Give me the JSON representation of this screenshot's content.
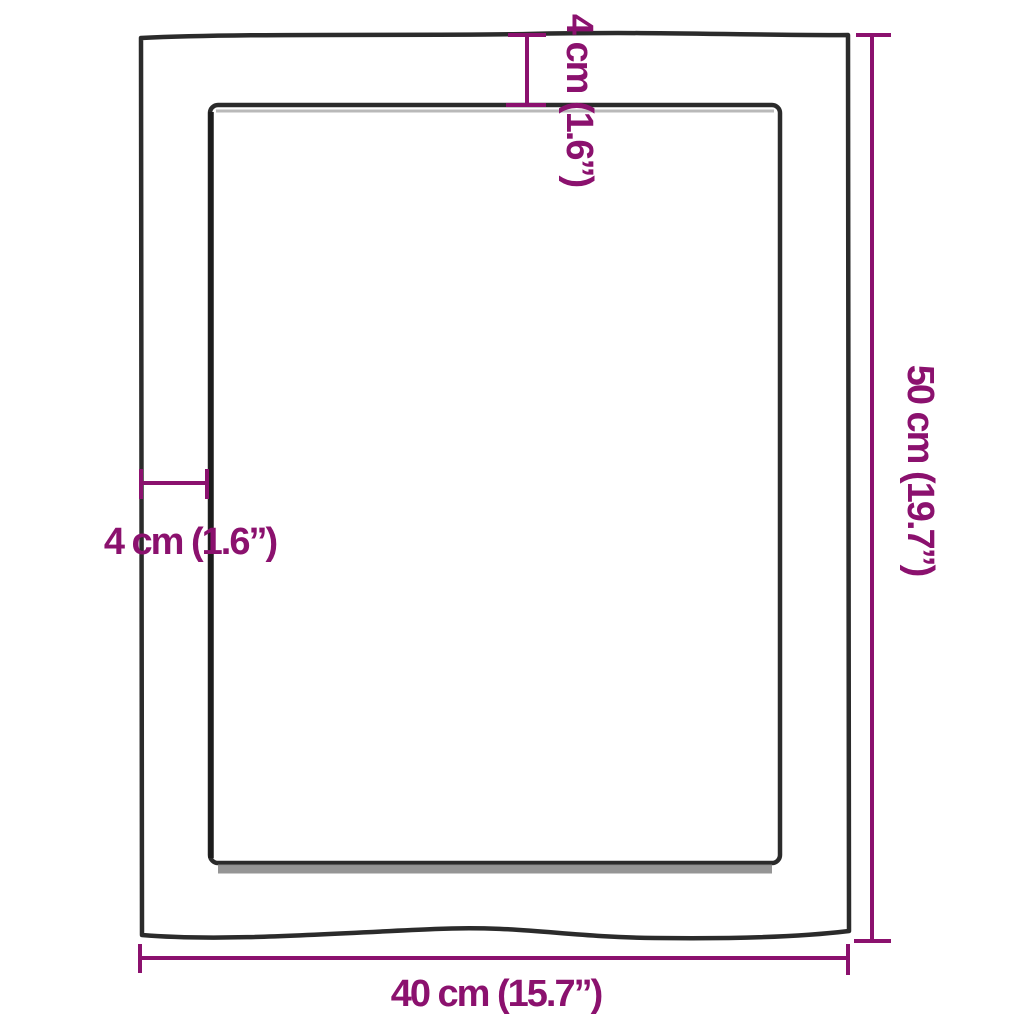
{
  "diagram": {
    "kind": "product-dimension-drawing",
    "shapes": {
      "outer_panel": "panel outline with wavy natural edge",
      "inner_recess": "inner rectangle recess with gray shadow"
    }
  },
  "dimensions": {
    "width": {
      "label": "40 cm (15.7”)",
      "cm": "40",
      "inches": "15.7",
      "side": "bottom"
    },
    "height": {
      "label": "50 cm (19.7”)",
      "cm": "50",
      "inches": "19.7",
      "side": "right"
    },
    "thickness_top": {
      "label": "4 cm (1.6”)",
      "cm": "4",
      "inches": "1.6",
      "side": "top"
    },
    "thickness_side": {
      "label": "4 cm (1.6”)",
      "cm": "4",
      "inches": "1.6",
      "side": "left"
    }
  },
  "colors": {
    "dimension_accent": "#8B116E",
    "panel_outline": "#2B2B2B",
    "recess_shadow": "#8A8A8A",
    "background": "#FFFFFF"
  }
}
